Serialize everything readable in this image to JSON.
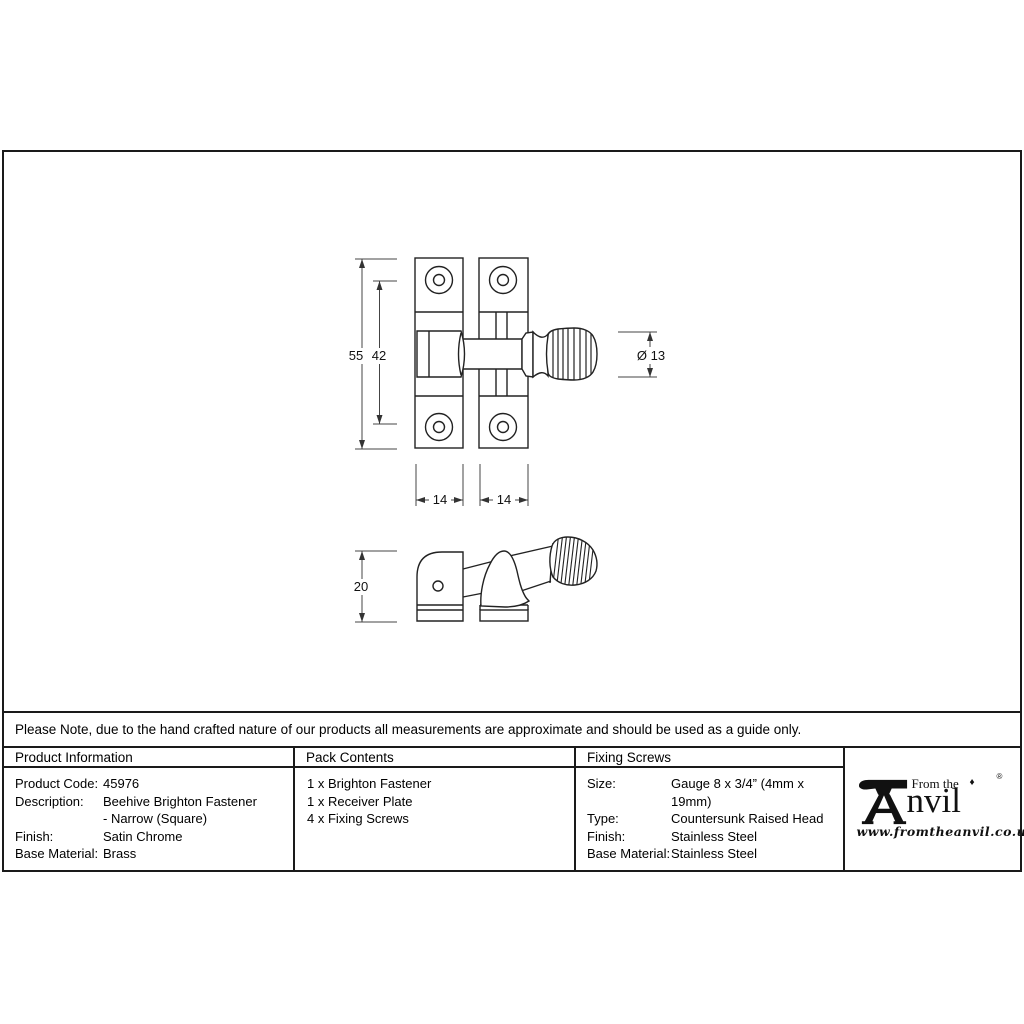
{
  "note": "Please Note, due to the hand crafted nature of our products all measurements are approximate and should be used as a guide only.",
  "table": {
    "product_information": {
      "header": "Product Information",
      "rows": [
        {
          "label": "Product Code:",
          "value": "45976"
        },
        {
          "label": "Description:",
          "value": "Beehive Brighton Fastener"
        },
        {
          "label": "",
          "value": "- Narrow (Square)"
        },
        {
          "label": "Finish:",
          "value": "Satin Chrome"
        },
        {
          "label": "Base Material:",
          "value": "Brass"
        }
      ]
    },
    "pack_contents": {
      "header": "Pack Contents",
      "items": [
        "1 x Brighton Fastener",
        "1 x Receiver Plate",
        "4 x Fixing Screws"
      ]
    },
    "fixing_screws": {
      "header": "Fixing Screws",
      "rows": [
        {
          "label": "Size:",
          "value": "Gauge 8 x 3/4” (4mm x 19mm)"
        },
        {
          "label": "Type:",
          "value": "Countersunk Raised Head"
        },
        {
          "label": "Finish:",
          "value": "Stainless Steel"
        },
        {
          "label": "Base Material:",
          "value": "Stainless Steel"
        }
      ]
    }
  },
  "logo": {
    "tagline": "From the",
    "brand": "nvil",
    "diamond": "♦",
    "registered": "®",
    "website": "www.fromtheanvil.co.uk"
  },
  "drawing": {
    "dimensions": {
      "overall_height": "55",
      "hole_spacing": "42",
      "knob_diameter": "Ø 13",
      "plate_width_left": "14",
      "plate_width_right": "14",
      "side_height": "20"
    }
  },
  "colors": {
    "line": "#1a1a1a",
    "dimension_line": "#444444",
    "background": "#ffffff",
    "text": "#000000"
  }
}
